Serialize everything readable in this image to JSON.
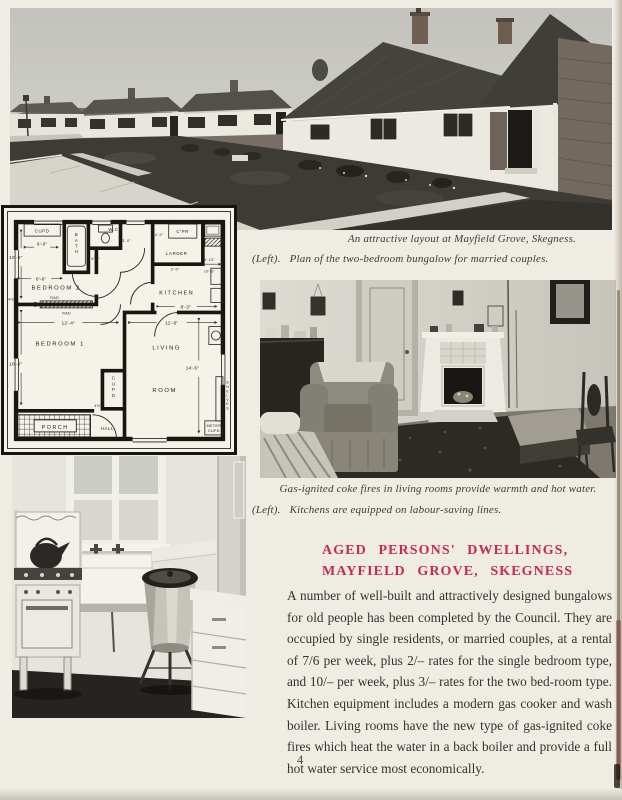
{
  "page": {
    "number": "4",
    "colors": {
      "paper": "#efece3",
      "heading_red": "#c72953",
      "body_ink": "#33322d",
      "caption_ink": "#3c3b35"
    }
  },
  "captions": {
    "street_photo": "An attractive layout at Mayfield Grove, Skegness.",
    "plan_prefix": "(Left).",
    "plan_text": "Plan of the two-bedroom bungalow for married couples.",
    "living_photo": "Gas-ignited coke fires in living rooms provide warmth and hot water.",
    "kitchen_prefix": "(Left).",
    "kitchen_text": "Kitchens are equipped on labour-saving lines."
  },
  "article": {
    "heading_line1": "AGED PERSONS' DWELLINGS,",
    "heading_line2": "MAYFIELD GROVE, SKEGNESS",
    "body": "A number of well-built and attractively designed bungalows for old people has been completed by the Council. They are occupied by single residents, or married couples, at a rental of 7/6 per week, plus 2/– rates for the single bedroom type, and 10/– per week, plus 3/– rates for the two bed-room type. Kitchen equipment includes a modern gas cooker and wash boiler. Living rooms have the new type of gas-ignited coke fires which heat the water in a back boiler and provide a full hot water service most economically."
  },
  "plan": {
    "labels": {
      "bedroom2": "BEDROOM 2",
      "bedroom1": "BEDROOM 1",
      "living": "LIVING",
      "room": "ROOM",
      "kitchen": "KITCHEN",
      "bath": "BATH",
      "wc": "W.C",
      "larder": "LARDER",
      "copper": "C'PR",
      "cupd_top": "CUPD",
      "cupd_closet": "CUPD",
      "shelves": "SHELVES",
      "meter_l1": "METER",
      "meter_l2": "CUPD",
      "hall": "HALL",
      "porch": "PORCH",
      "rad": "RAD"
    },
    "dims": {
      "bed2_w": "8'-6\"",
      "bed2_d": "10'-5\"",
      "bed1_w": "12'-4\"",
      "bed1_d": "10'-6\"",
      "liv_w": "11'-8\"",
      "liv_d": "14'-5\"",
      "kit_w": "8'-3\"",
      "kit_d": "5'-10\"",
      "kit_d2": "10'-6\"",
      "cupd_w": "6'-0\"",
      "bath_w": "6'-0\"",
      "larder_w": "4'-2\"",
      "pass_w": "3'-0\"",
      "larder_d": "2'-0\"",
      "wall_t": "4½\""
    }
  }
}
